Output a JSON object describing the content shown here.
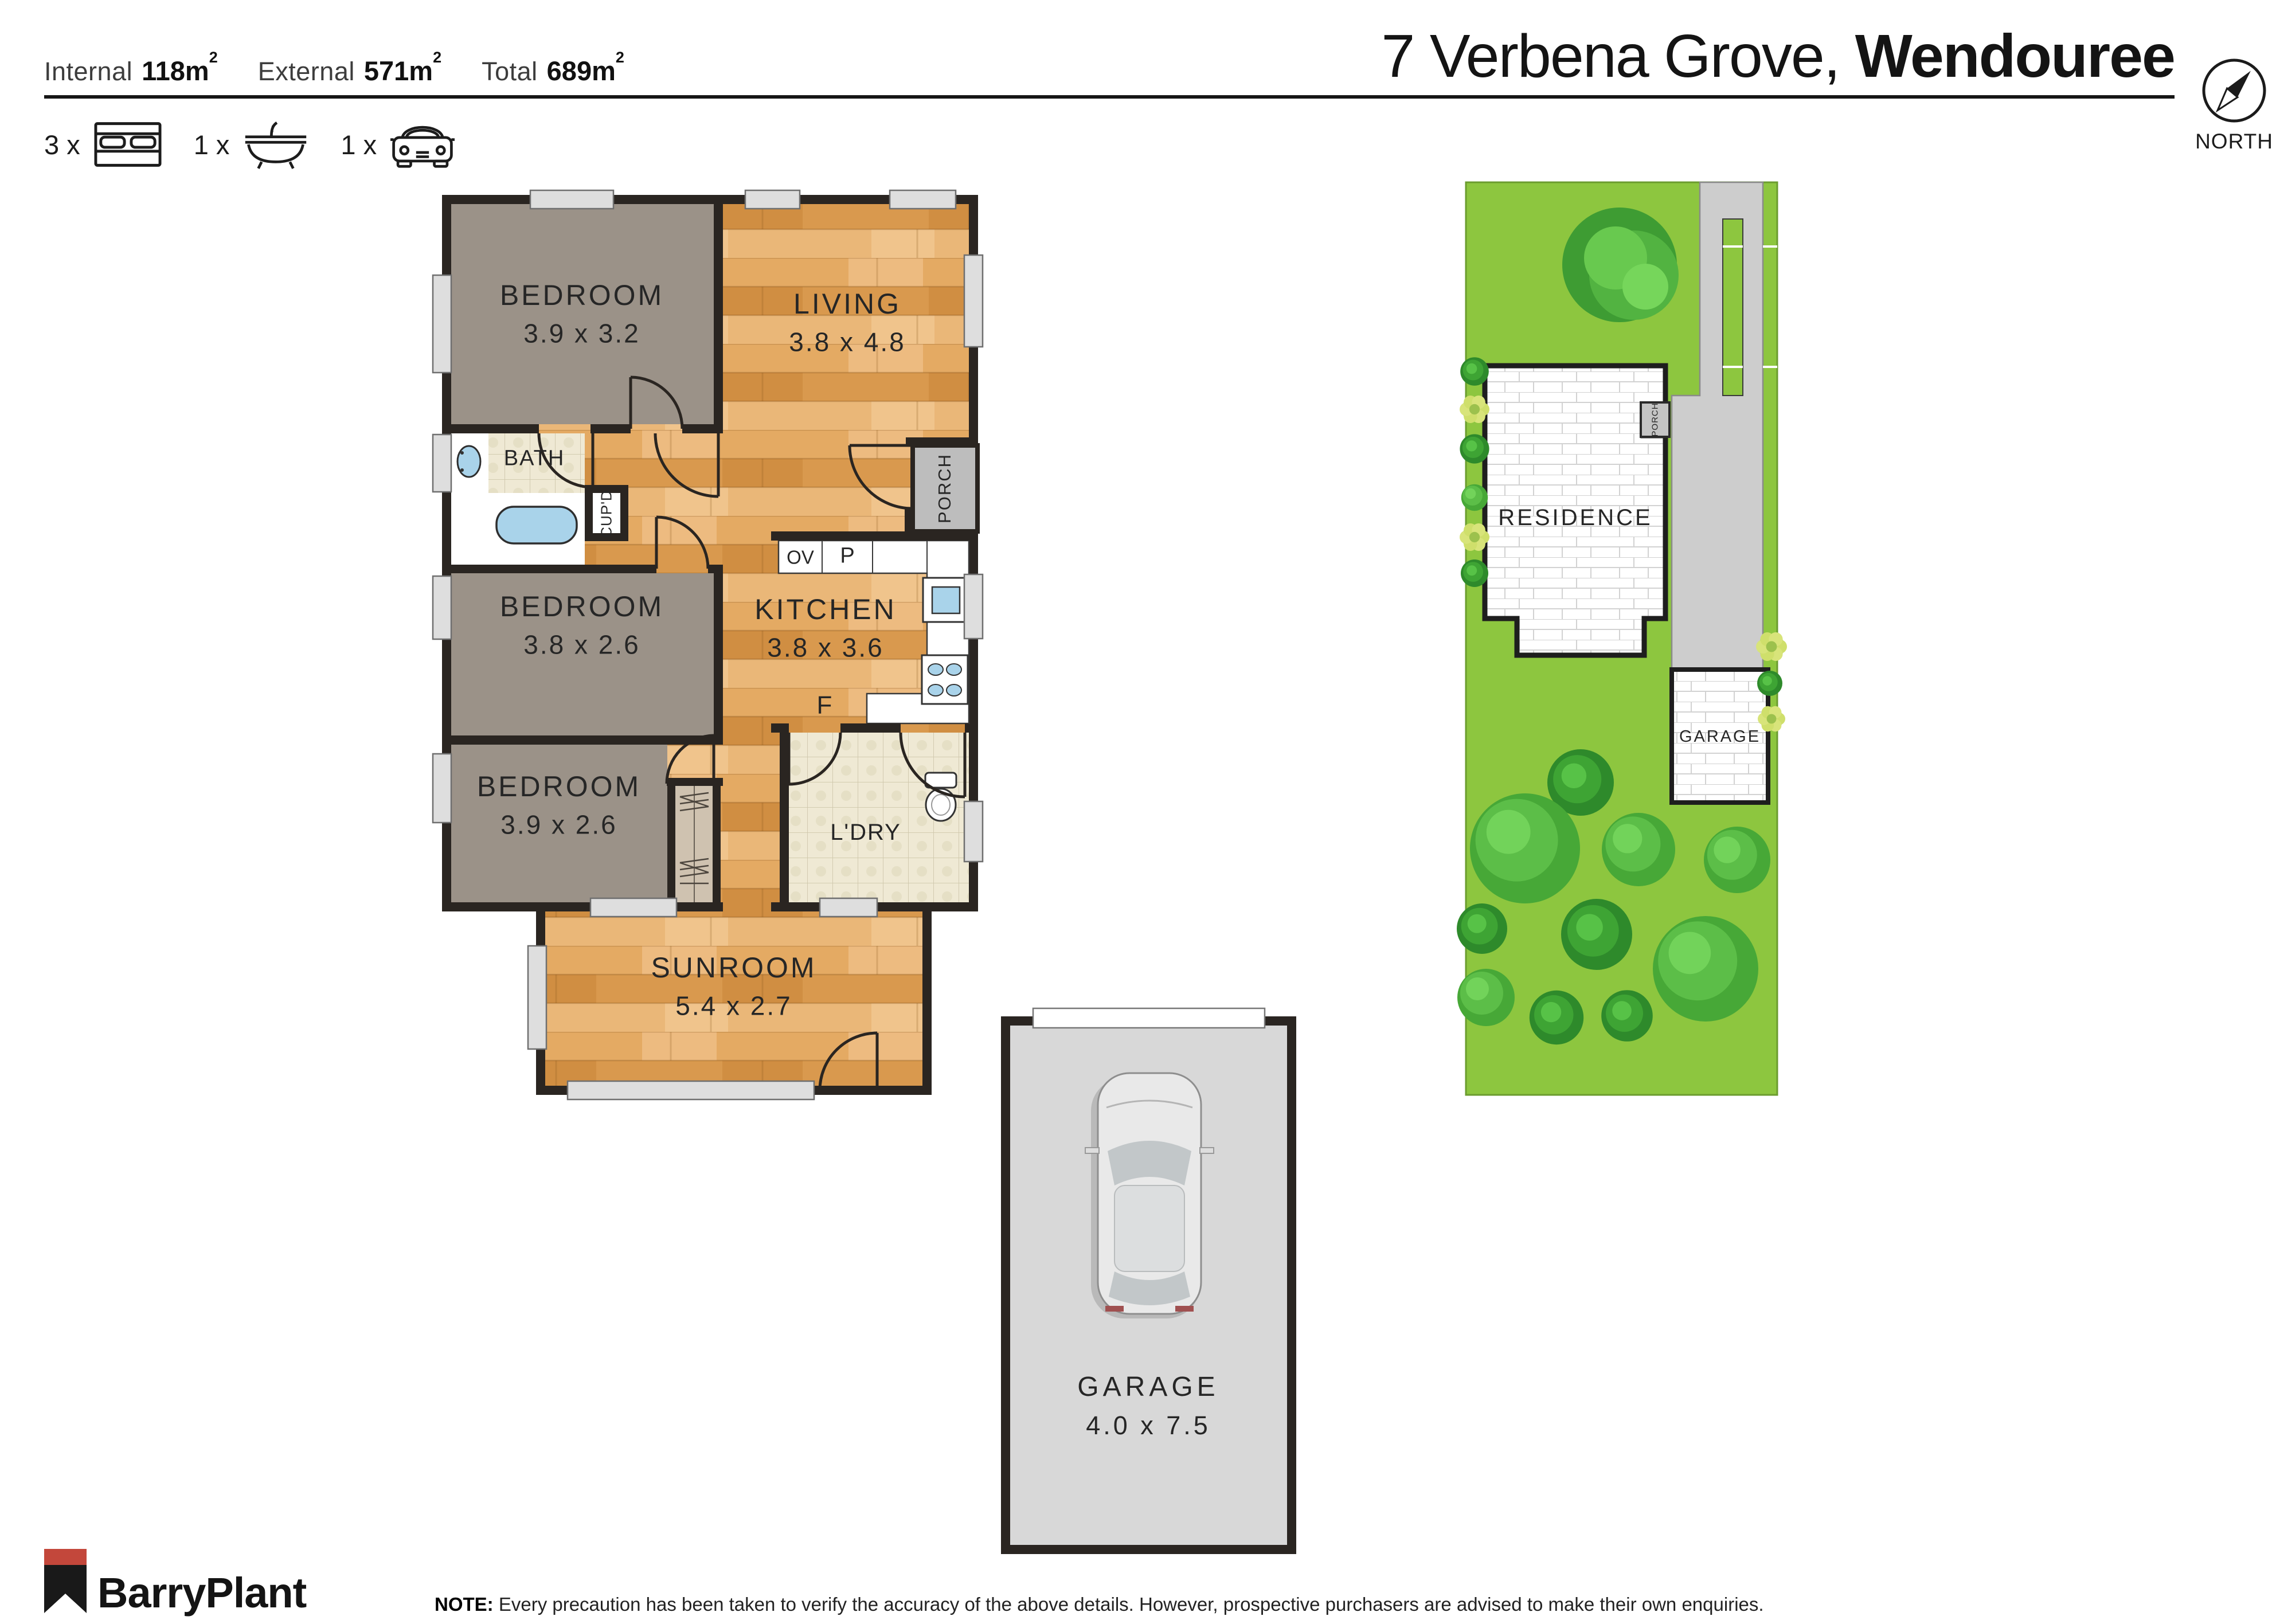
{
  "header": {
    "stats": [
      {
        "label": "Internal",
        "value": "118m",
        "sup": "2"
      },
      {
        "label": "External",
        "value": "571m",
        "sup": "2"
      },
      {
        "label": "Total",
        "value": "689m",
        "sup": "2"
      }
    ],
    "features": [
      {
        "count": "3 x",
        "icon": "bed-icon"
      },
      {
        "count": "1 x",
        "icon": "bath-icon"
      },
      {
        "count": "1 x",
        "icon": "car-icon"
      }
    ],
    "address": {
      "street": "7 Verbena Grove,",
      "suburb": "Wendouree"
    },
    "compass_label": "NORTH"
  },
  "floorplan": {
    "rooms": [
      {
        "id": "bedroom1",
        "name": "BEDROOM",
        "dims": "3.9 x 3.2"
      },
      {
        "id": "living",
        "name": "LIVING",
        "dims": "3.8 x 4.8"
      },
      {
        "id": "bedroom2",
        "name": "BEDROOM",
        "dims": "3.8 x 2.6"
      },
      {
        "id": "kitchen",
        "name": "KITCHEN",
        "dims": "3.8 x 3.6"
      },
      {
        "id": "bedroom3",
        "name": "BEDROOM",
        "dims": "3.9 x 2.6"
      },
      {
        "id": "sunroom",
        "name": "SUNROOM",
        "dims": "5.4 x 2.7"
      },
      {
        "id": "garage",
        "name": "GARAGE",
        "dims": "4.0 x 7.5"
      }
    ],
    "labels": {
      "bath": "BATH",
      "cupboard": "CUP'D",
      "porch": "PORCH",
      "oven": "OV",
      "pantry": "P",
      "fridge": "F",
      "laundry": "L'DRY"
    }
  },
  "siteplan": {
    "residence": "RESIDENCE",
    "garage": "GARAGE",
    "porch": "PORCH"
  },
  "footer": {
    "brand": "BarryPlant",
    "note_label": "NOTE:",
    "note": "Every precaution has been taken to verify the accuracy of the above details. However, prospective purchasers are advised to make their own enquiries."
  },
  "colors": {
    "lawn": "#8DC63F",
    "driveway": "#CDCDCD",
    "wood_floor": "#DFA55D",
    "carpet": "#9B9288",
    "wall": "#2A2521",
    "fixture_blue": "#A9D3EA",
    "logo_red": "#C3473B"
  }
}
